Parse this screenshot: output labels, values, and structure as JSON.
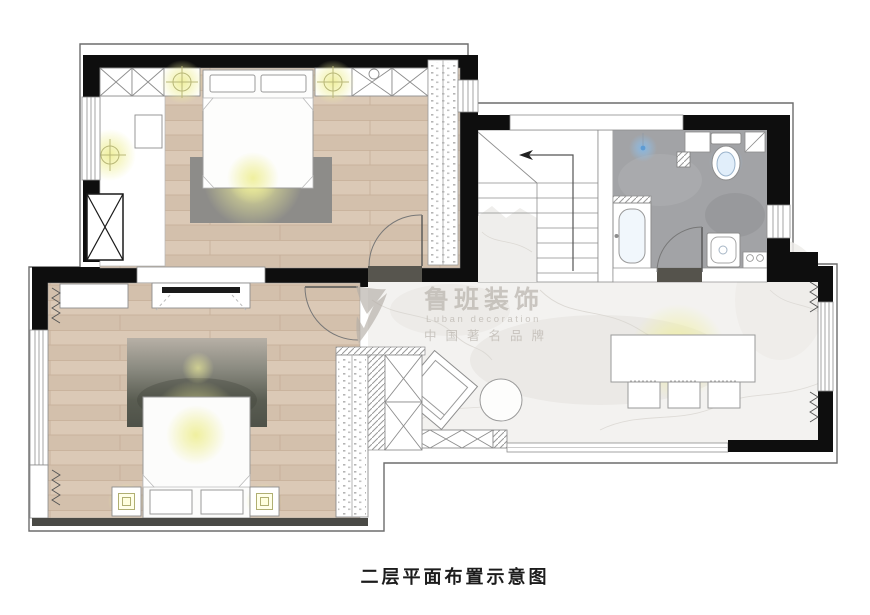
{
  "caption": {
    "text": "二层平面布置示意图"
  },
  "watermark": {
    "brand_cn": "鲁班装饰",
    "brand_en": "Luban decoration",
    "tagline": "中国著名品牌"
  },
  "colors": {
    "wall": "#0e0e0e",
    "wood_floor": "#d8c6b3",
    "bath_floor": "#a2a3a6",
    "marble_floor": "#f3f2f0",
    "rug_gray": "#8d8c89",
    "rug_dark": "#53564c",
    "threshold": "#55534c",
    "light_glow": "#eeee96",
    "water_glow": "#82b9eb",
    "watermark_gray": "#b4aea7"
  }
}
